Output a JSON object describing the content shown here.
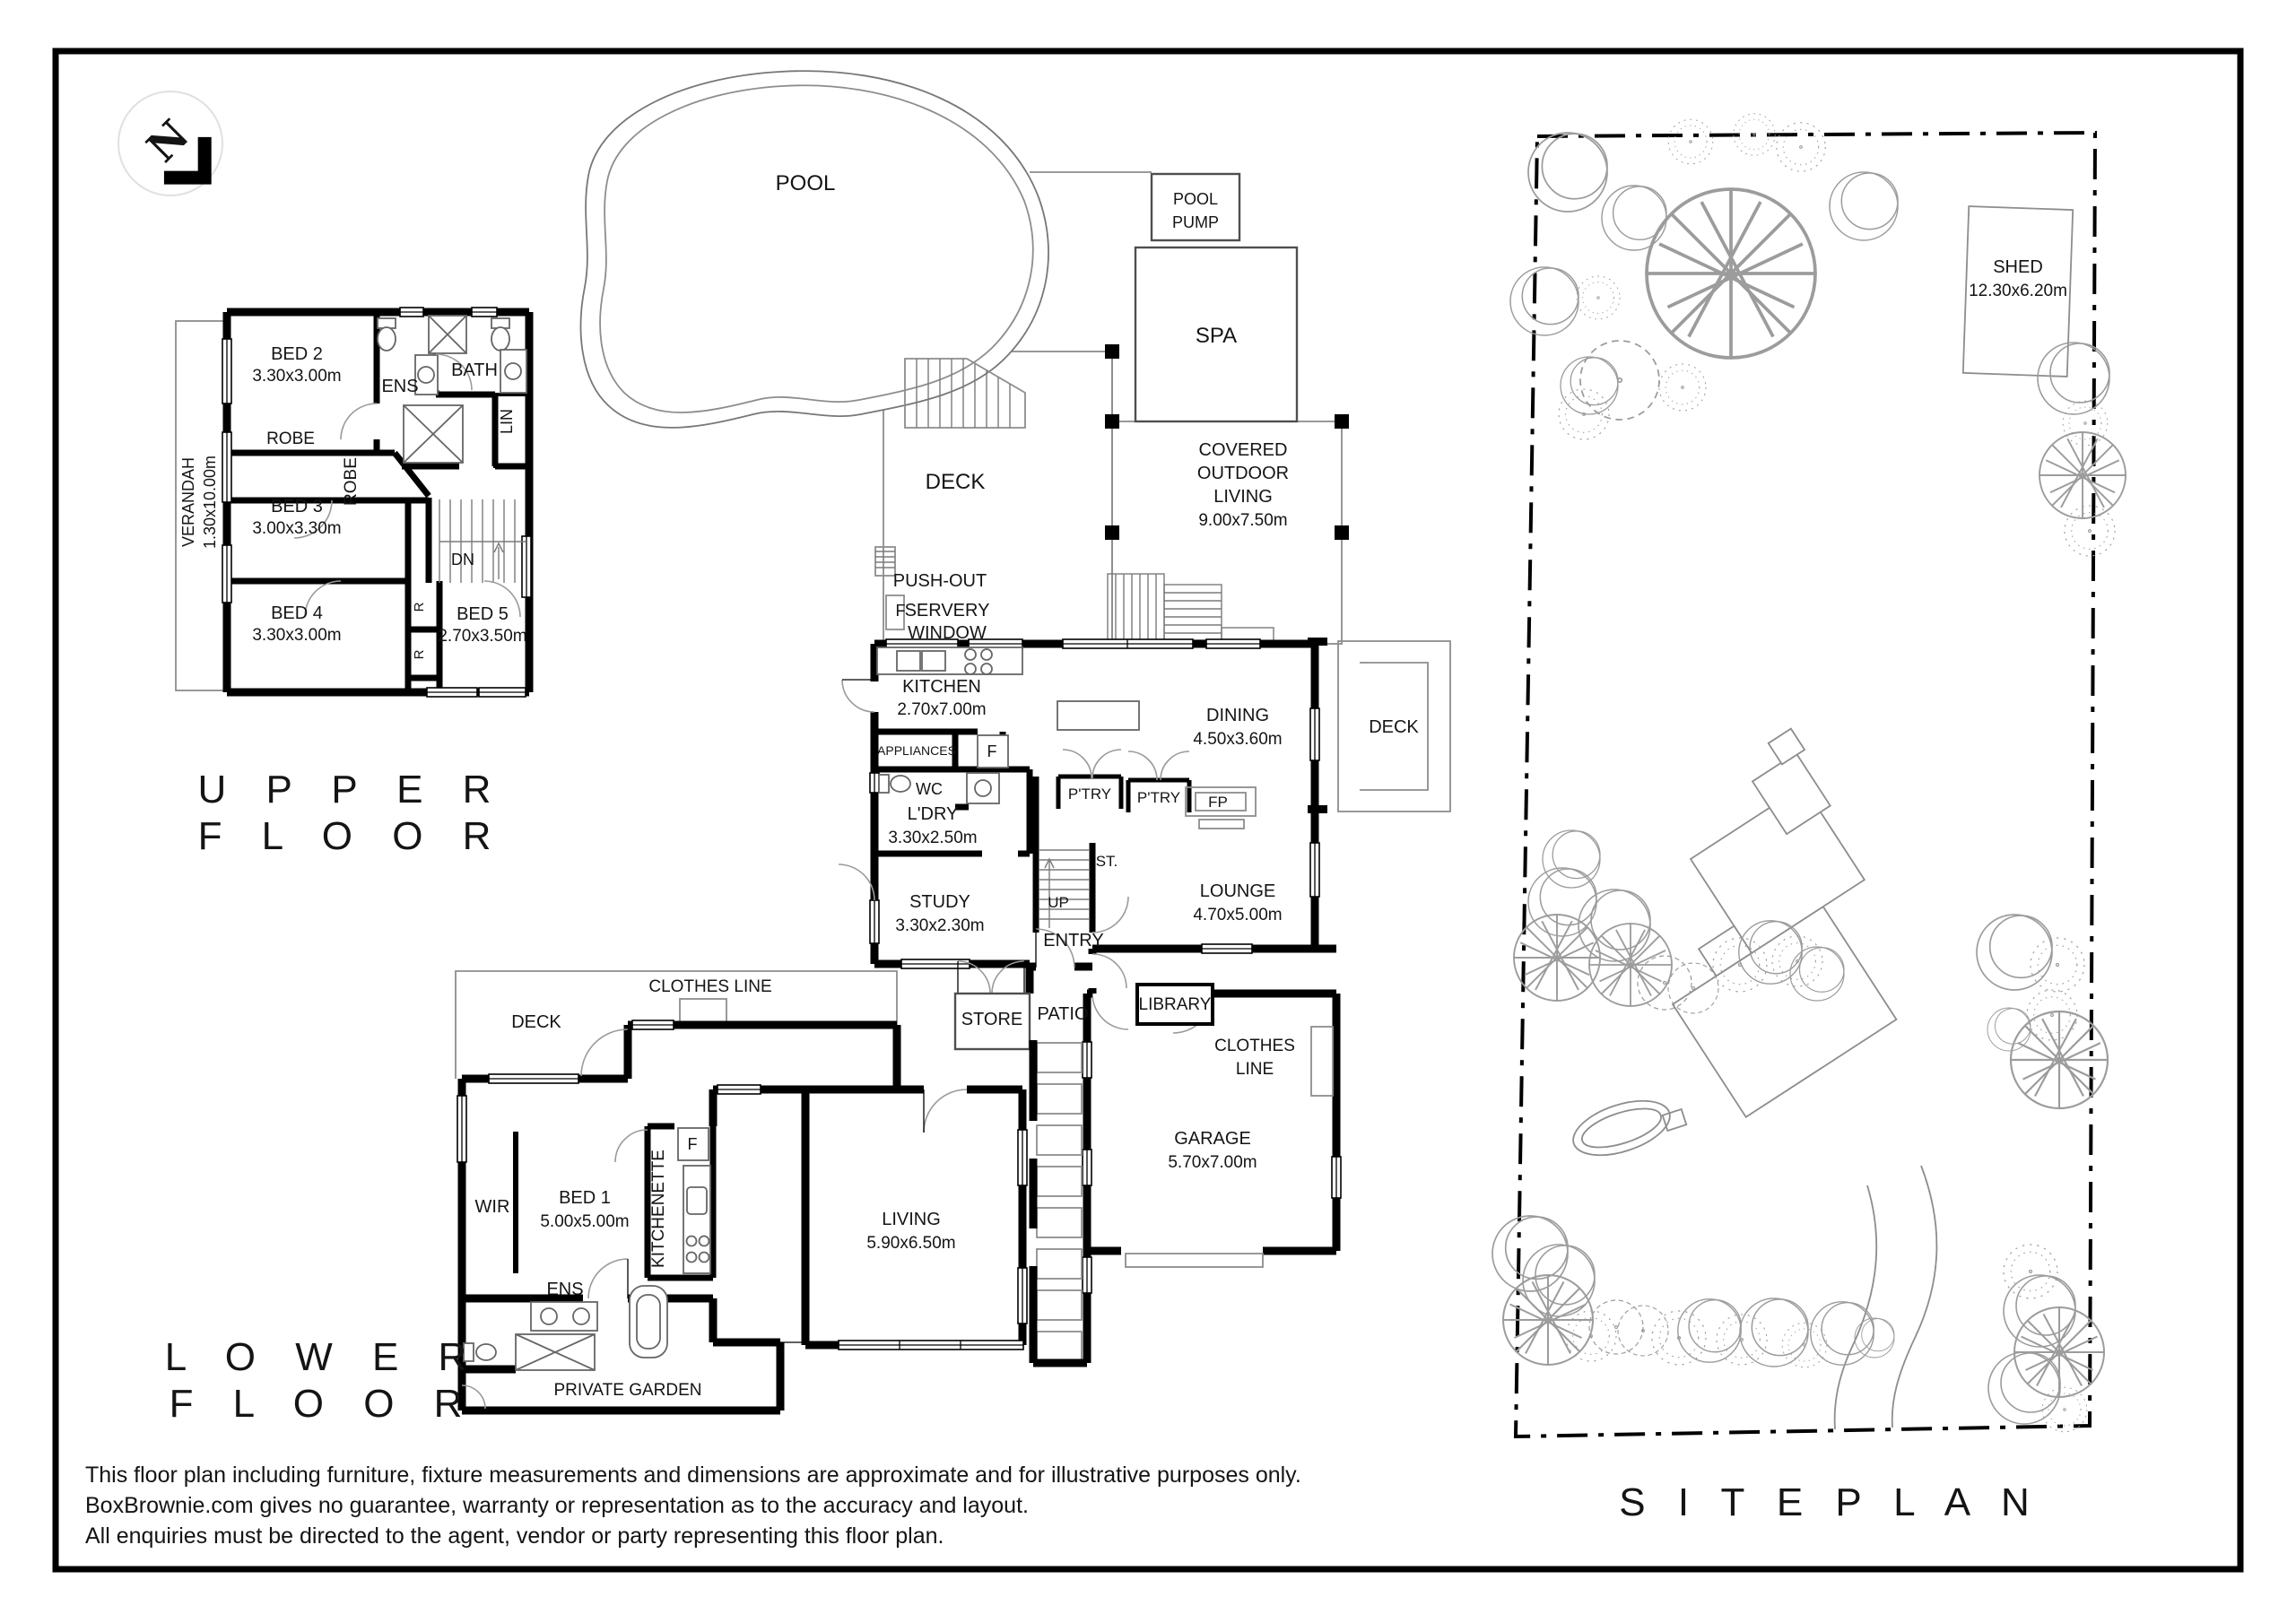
{
  "north": {
    "label": "N"
  },
  "upper_floor": {
    "title_l1": "U P P E R",
    "title_l2": "F L O O R",
    "verandah_name": "VERANDAH",
    "verandah_dims": "1.30x10.00m",
    "bed2_name": "BED 2",
    "bed2_dims": "3.30x3.00m",
    "ens": "ENS",
    "bath": "BATH",
    "lin": "LIN",
    "robe1": "ROBE",
    "robe2": "ROBE",
    "bed3_name": "BED 3",
    "bed3_dims": "3.00x3.30m",
    "dn": "DN",
    "bed4_name": "BED 4",
    "bed4_dims": "3.30x3.00m",
    "r1": "R",
    "r2": "R",
    "bed5_name": "BED 5",
    "bed5_dims": "2.70x3.50m"
  },
  "ground_floor": {
    "pool": "POOL",
    "pool_pump_l1": "POOL",
    "pool_pump_l2": "PUMP",
    "spa": "SPA",
    "deck_pool": "DECK",
    "covered_l1": "COVERED",
    "covered_l2": "OUTDOOR",
    "covered_l3": "LIVING",
    "covered_l4": "9.00x7.50m",
    "servery_l1": "PUSH-OUT",
    "servery_l2": "SERVERY",
    "servery_l3": "WINDOW",
    "servery_f": "F",
    "kitchen_name": "KITCHEN",
    "kitchen_dims": "2.70x7.00m",
    "appliances": "APPLIANCES",
    "fridge": "F",
    "wc": "WC",
    "ldry_name": "L'DRY",
    "ldry_dims": "3.30x2.50m",
    "study_name": "STUDY",
    "study_dims": "3.30x2.30m",
    "dining_name": "DINING",
    "dining_dims": "4.50x3.60m",
    "ptry1": "P'TRY",
    "ptry2": "P'TRY",
    "fp": "FP",
    "st": "ST.",
    "up": "UP",
    "lounge_name": "LOUNGE",
    "lounge_dims": "4.70x5.00m",
    "deck_right": "DECK",
    "entry": "ENTRY",
    "store": "STORE",
    "patio": "PATIO",
    "library": "LIBRARY",
    "clothes_l1": "CLOTHES",
    "clothes_l2": "LINE",
    "garage_name": "GARAGE",
    "garage_dims": "5.70x7.00m"
  },
  "lower_floor": {
    "title_l1": "L O W E R",
    "title_l2": "F L O O R",
    "clothes_line": "CLOTHES LINE",
    "deck": "DECK",
    "wir": "WIR",
    "bed1_name": "BED 1",
    "bed1_dims": "5.00x5.00m",
    "kitchenette": "KITCHENETTE",
    "fridge": "F",
    "ens": "ENS",
    "living_name": "LIVING",
    "living_dims": "5.90x6.50m",
    "private_garden": "PRIVATE GARDEN"
  },
  "site_plan": {
    "title": "S I T E  P L A N",
    "shed_name": "SHED",
    "shed_dims": "12.30x6.20m"
  },
  "disclaimer": {
    "line1": "This floor plan including furniture, fixture measurements and dimensions are approximate and for illustrative purposes only.",
    "line2": "BoxBrownie.com gives no guarantee, warranty or representation as to the accuracy and layout.",
    "line3": "All enquiries must be directed to the agent, vendor or party representing this floor plan."
  }
}
